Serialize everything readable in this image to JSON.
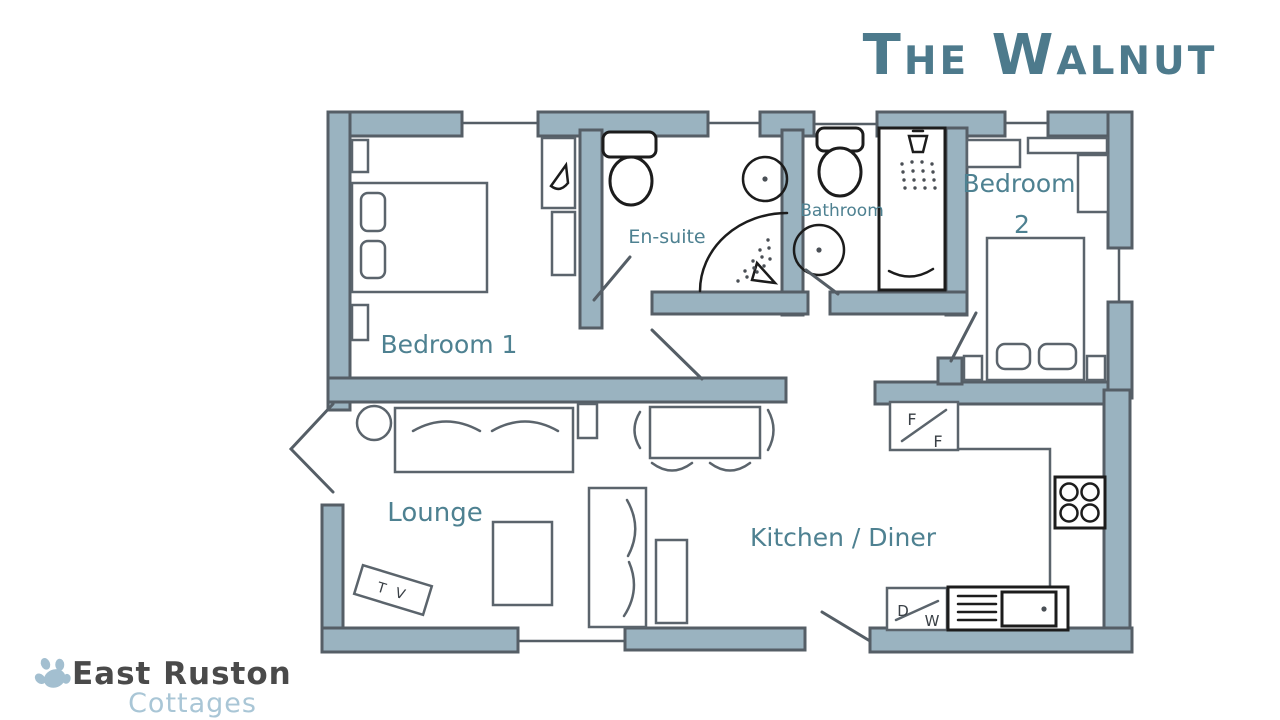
{
  "title": "The Walnut",
  "rooms": {
    "bedroom1": "Bedroom 1",
    "ensuite": "En-suite",
    "bathroom": "Bathroom",
    "bedroom2_word": "Bedroom",
    "bedroom2_number": "2",
    "lounge": "Lounge",
    "kitchen": "Kitchen / Diner"
  },
  "furniture_labels": {
    "tv": "T V",
    "fridge_top": "F",
    "fridge_bottom": "F",
    "dishwasher_left": "D",
    "dishwasher_right": "W"
  },
  "logo": {
    "name": "East Ruston",
    "tagline": "Cottages"
  },
  "colors": {
    "wall": "#9ab3c0",
    "wall_outline": "#555e66",
    "room_label": "#4e8191",
    "title_text": "#4d7a8c",
    "ink": "#1c1c1c",
    "furniture_line": "#5b646c",
    "logo_dark": "#4a4a4a",
    "logo_light": "#a9c6d6",
    "paw": "#a3bfd0"
  }
}
